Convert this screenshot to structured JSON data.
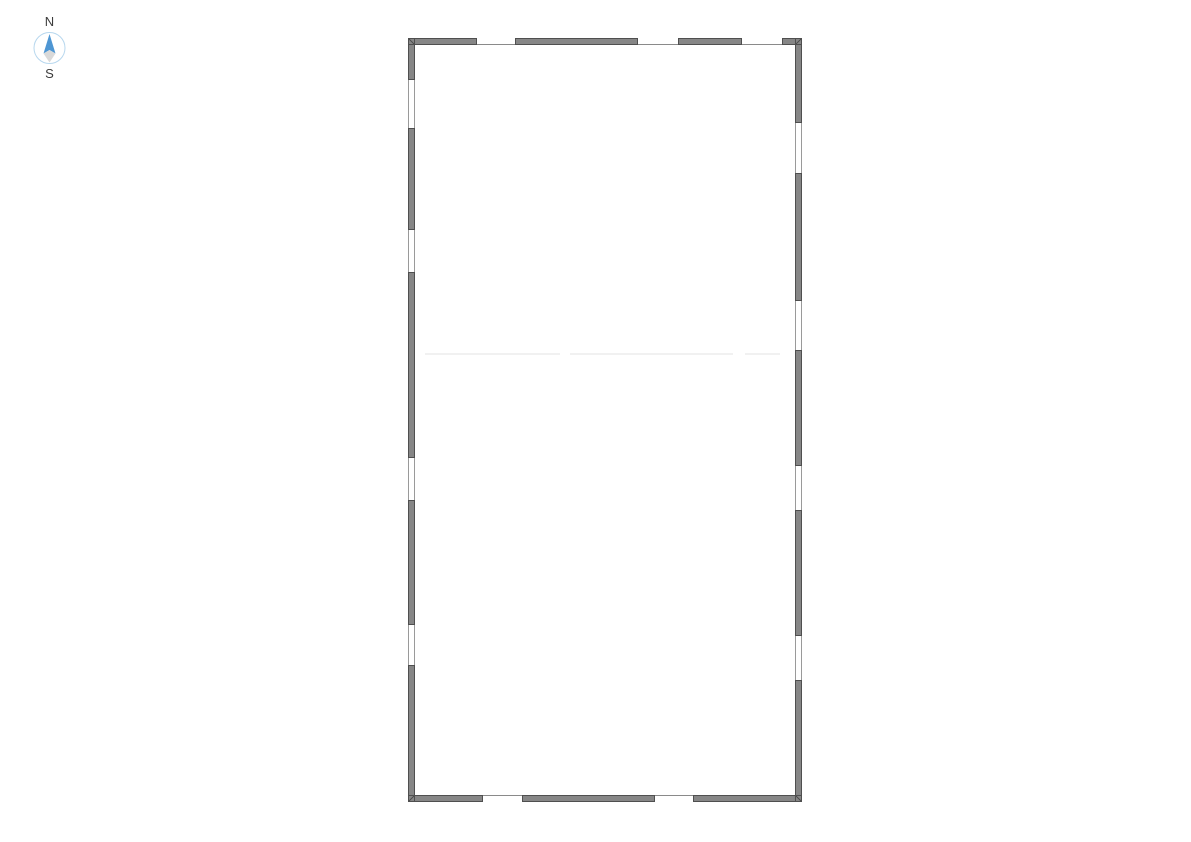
{
  "compass": {
    "north_label": "N",
    "south_label": "S",
    "circle_color": "#b7d7ee",
    "north_arrow_color": "#4e96d3",
    "south_arrow_color": "#d9d9d9",
    "label_color": "#3c3c3c"
  },
  "floor_plan": {
    "wall_fill": "#868686",
    "wall_edge": "#4f4f4f",
    "window_frame_color": "#9a9a9a",
    "opening_line_color": "#8a8a8a",
    "faint_line_color": "#f1f1f1",
    "floor_color": "#ffffff",
    "wall_thickness": 7,
    "outer": {
      "x": 408,
      "y": 38,
      "width": 394,
      "height": 764
    },
    "walls": {
      "top": {
        "y": 38,
        "segments": [
          {
            "x": 408,
            "w": 69
          },
          {
            "x": 515,
            "w": 123
          },
          {
            "x": 678,
            "w": 64
          },
          {
            "x": 782,
            "w": 20
          }
        ],
        "openings": [
          {
            "x": 477,
            "w": 38
          },
          {
            "x": 638,
            "w": 40
          },
          {
            "x": 742,
            "w": 40
          }
        ]
      },
      "bottom": {
        "y": 795,
        "segments": [
          {
            "x": 408,
            "w": 75
          },
          {
            "x": 522,
            "w": 133
          },
          {
            "x": 693,
            "w": 109
          }
        ],
        "openings": [
          {
            "x": 483,
            "w": 39
          },
          {
            "x": 655,
            "w": 38
          }
        ]
      },
      "left": {
        "x": 408,
        "segments": [
          {
            "y": 38,
            "h": 42
          },
          {
            "y": 128,
            "h": 102
          },
          {
            "y": 272,
            "h": 186
          },
          {
            "y": 500,
            "h": 125
          },
          {
            "y": 665,
            "h": 137
          }
        ],
        "windows": [
          {
            "y": 80,
            "h": 48
          },
          {
            "y": 230,
            "h": 42
          },
          {
            "y": 458,
            "h": 42
          },
          {
            "y": 625,
            "h": 40
          }
        ]
      },
      "right": {
        "x": 795,
        "segments": [
          {
            "y": 38,
            "h": 85
          },
          {
            "y": 173,
            "h": 128
          },
          {
            "y": 350,
            "h": 116
          },
          {
            "y": 510,
            "h": 126
          },
          {
            "y": 680,
            "h": 122
          }
        ],
        "windows": [
          {
            "y": 123,
            "h": 50
          },
          {
            "y": 301,
            "h": 49
          },
          {
            "y": 466,
            "h": 44
          },
          {
            "y": 636,
            "h": 44
          }
        ]
      }
    },
    "divider_y": 353,
    "divider_segments": [
      {
        "x": 425,
        "w": 135
      },
      {
        "x": 570,
        "w": 163
      },
      {
        "x": 745,
        "w": 35
      }
    ]
  }
}
